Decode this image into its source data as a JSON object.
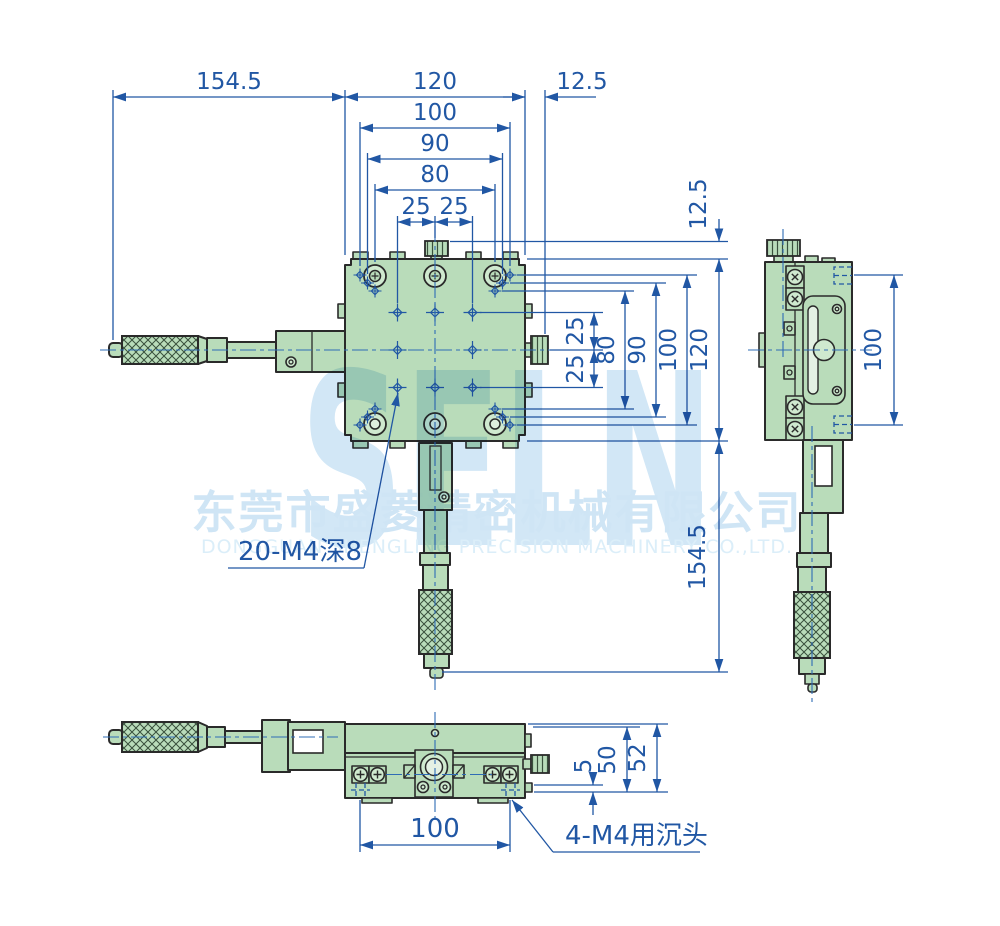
{
  "drawing": {
    "watermark": {
      "logo": "SELN",
      "company_cn": "东莞市盛菱精密机械有限公司",
      "company_en": "DONGGUAN SHENGLING PRECISION MACHINERY CO.,LTD."
    },
    "callouts": {
      "threaded_holes": "20-M4深8",
      "counterbore": "4-M4用沉头"
    },
    "dims": {
      "top": {
        "overall_left": "154.5",
        "stage_width": "120",
        "knob_offset": "12.5",
        "holes_100": "100",
        "holes_90": "90",
        "holes_80": "80",
        "grid_left": "25",
        "grid_right": "25"
      },
      "right": {
        "top_offset": "12.5",
        "grid_up": "25",
        "grid_down": "25",
        "holes_80": "80",
        "holes_90": "90",
        "holes_100": "100",
        "stage_height": "120",
        "overall_bottom": "154.5"
      },
      "side": {
        "holes_100": "100"
      },
      "front": {
        "base_width": "100",
        "step": "5",
        "height_50": "50",
        "height_52": "52"
      }
    },
    "colors": {
      "dimension_blue": "#2157a4",
      "body_green": "#b9dcba",
      "outline_dark": "#2a2a2a",
      "watermark_blue": "#cfe6f6"
    }
  }
}
